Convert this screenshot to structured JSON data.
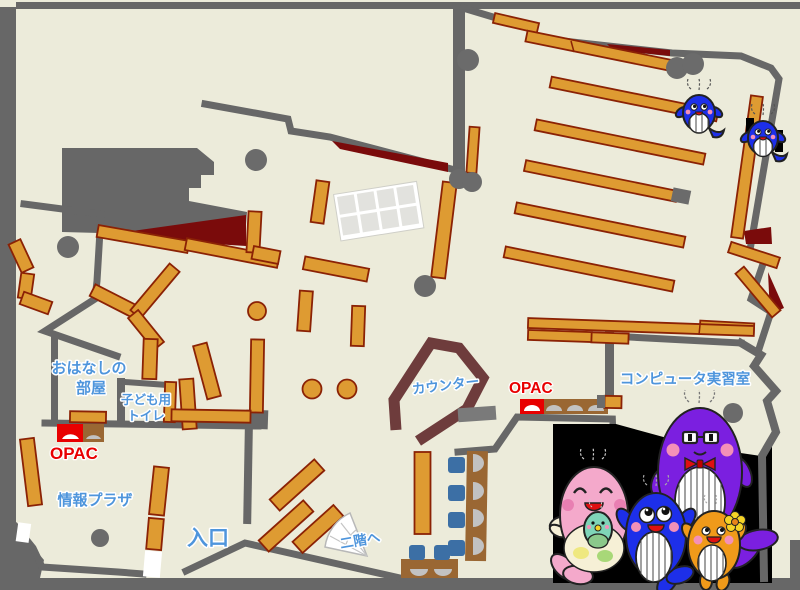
{
  "page": {
    "type": "library-floor-map",
    "floor_color": "#ECEBDA",
    "border_color": "#676767"
  },
  "labels": {
    "storytelling_room": {
      "line1": "おはなしの",
      "line2": "部屋"
    },
    "kids_toilet": {
      "line1": "子ども用",
      "line2": "トイレ"
    },
    "opac_left": "OPAC",
    "opac_right": "OPAC",
    "info_plaza": "情報プラザ",
    "entrance": "入口",
    "counter": "カウンター",
    "computer_room": "コンピュータ実習室",
    "to_second_floor": "二階へ"
  },
  "colors": {
    "label_blue": "#4E95DC",
    "opac_red": "#E80000",
    "shelf_orange": "#DE9B32",
    "shelf_border": "#8B2205",
    "wall_gray": "#676767",
    "accent_dark_red": "#7A0B0B",
    "counter_brown": "#6E3C3C",
    "desk_brown": "#9A6733",
    "chair_blue": "#3C6FA5",
    "mascot_panel_black": "#000000"
  },
  "mascots": {
    "panel": "whale-family",
    "members": [
      "mama-whale-pink",
      "baby-whale-teal",
      "papa-whale-purple",
      "kid-whale-blue",
      "kid-whale-orange",
      "small-whale-blue-1",
      "small-whale-blue-2"
    ]
  }
}
